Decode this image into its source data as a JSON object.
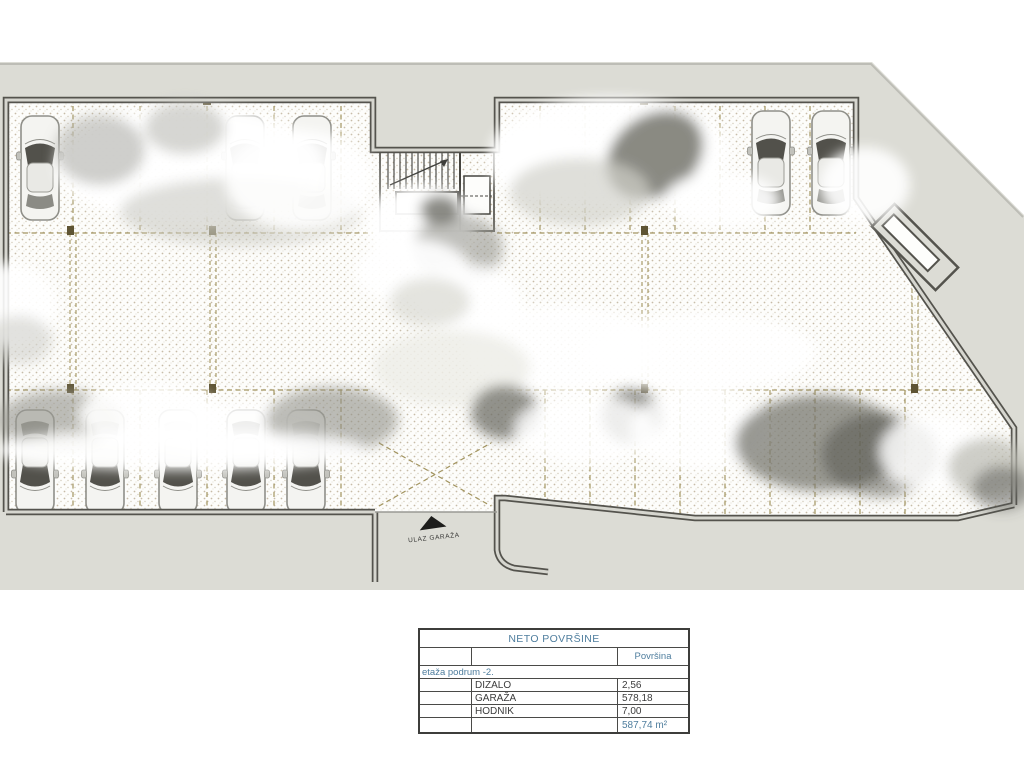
{
  "plan": {
    "entrance_label": "ULAZ GARAŽA"
  },
  "table": {
    "title": "NETO POVRŠINE",
    "area_column_header": "Površina",
    "floor_label": "etaža  podrum -2.",
    "rows": [
      {
        "name": "DIZALO",
        "area": "2,56"
      },
      {
        "name": "GARAŽA",
        "area": "578,18"
      },
      {
        "name": "HODNIK",
        "area": "7,00"
      }
    ],
    "total": "587,74 m²"
  },
  "colors": {
    "terrain_gray": "#dcdcd5",
    "wall_dark": "#54534d",
    "wall_light": "#d6d6cf",
    "hatch_tan": "#a2945f",
    "accent_blue": "#4f7e9e"
  }
}
